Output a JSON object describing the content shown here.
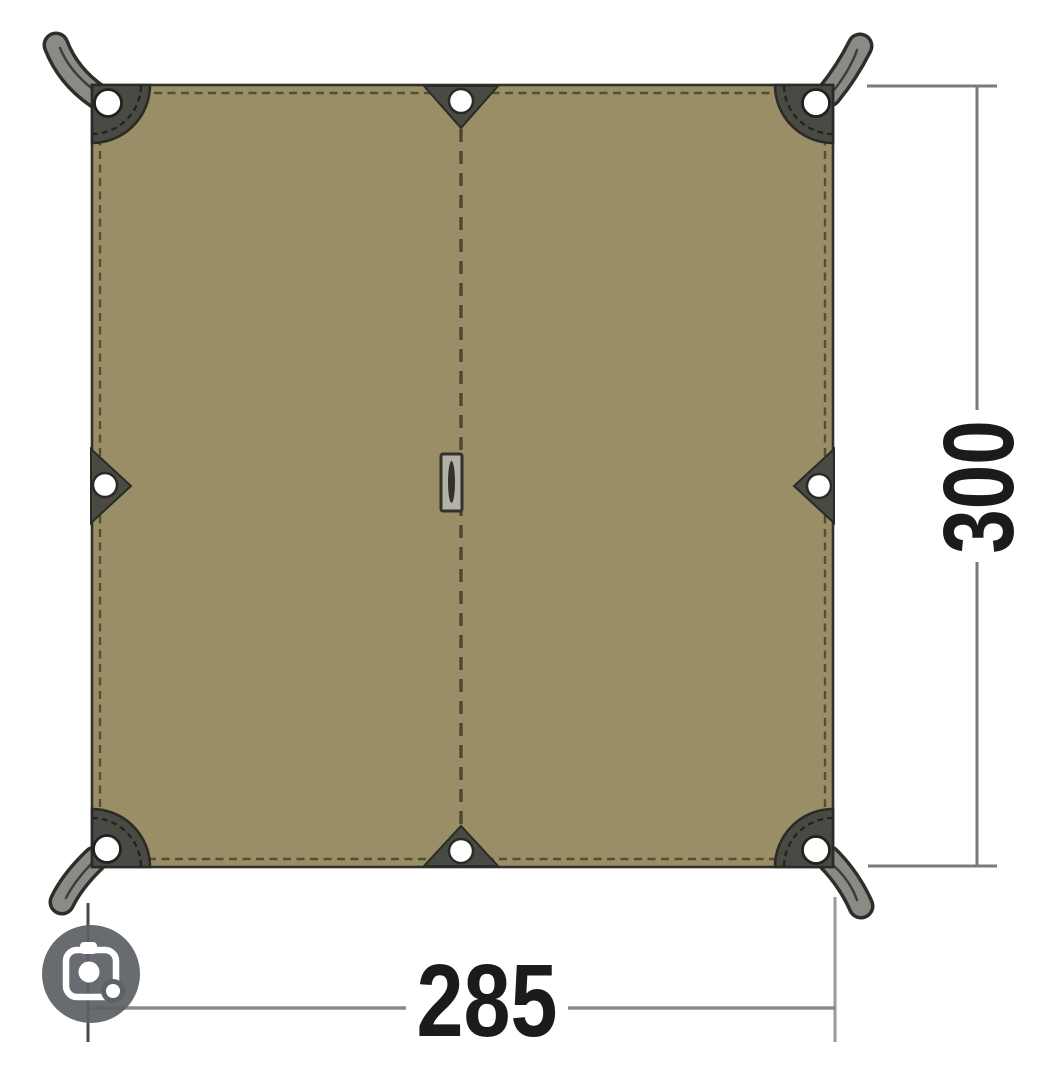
{
  "diagram": {
    "type": "product-dimension-diagram",
    "subject": "rectangular tarp, top view, with corner straps, edge grommet tabs and center seam",
    "dimensions": {
      "width": {
        "value": "285",
        "position": "bottom"
      },
      "height": {
        "value": "300",
        "position": "right"
      }
    },
    "colors": {
      "background": "#ffffff",
      "tarp_fabric": "#9a8e67",
      "tarp_outline": "#33302a",
      "stitch": "#564e33",
      "hardware": "#4a4a45",
      "hardware_outline": "#2b2a25",
      "strap_fill": "#8b8a85",
      "grommet": "#ffffff",
      "center_loop_fill": "#b3b2a9",
      "dimension_line": "#8a8a8a",
      "extension_line_dark": "#4a4a4a",
      "dimension_text": "#1b1b1b"
    }
  },
  "lens_button": {
    "icon": "camera-screenshot-search-icon",
    "background": "#5d6165",
    "glyph_color": "#ffffff"
  }
}
